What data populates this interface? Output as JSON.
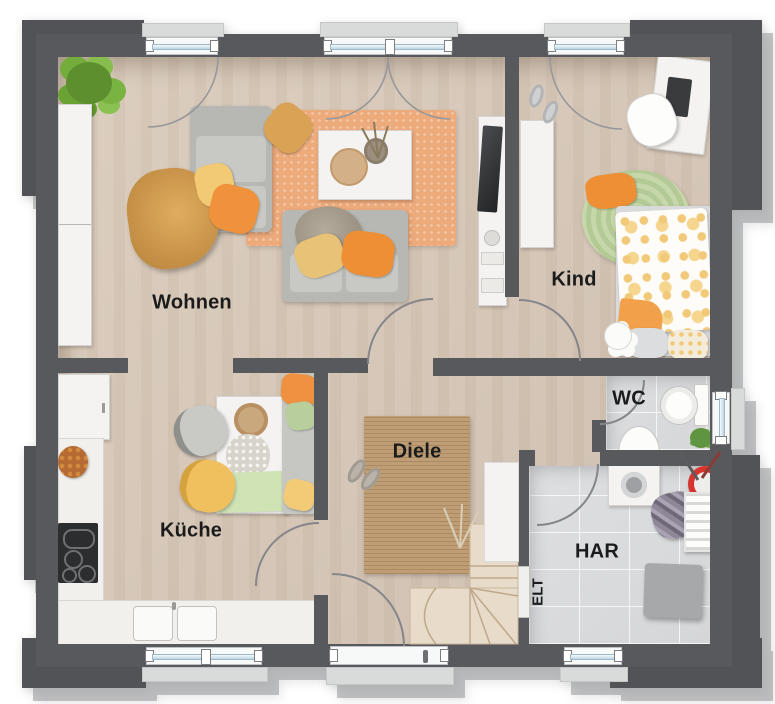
{
  "rooms": {
    "wohnen": {
      "label": "Wohnen"
    },
    "kind": {
      "label": "Kind"
    },
    "kueche": {
      "label": "Küche"
    },
    "diele": {
      "label": "Diele"
    },
    "wc": {
      "label": "WC"
    },
    "har": {
      "label": "HAR"
    },
    "elt": {
      "label": "ELT"
    }
  },
  "colors": {
    "wall": "#58595c",
    "wood_floor": "#d7c8b9",
    "tile_floor": "#d9dadc",
    "rug_orange": "#edaa7b",
    "rug_jute": "#bf9e76",
    "rug_green": "#c0d4a2",
    "accent_orange": "#ef9140",
    "accent_mustard": "#d9a254",
    "accent_yellow": "#f2c46d",
    "accent_green": "#bcd3a0",
    "window_glass": "#cfe3ee",
    "basket_red": "#d8352f",
    "background": "#ffffff"
  }
}
